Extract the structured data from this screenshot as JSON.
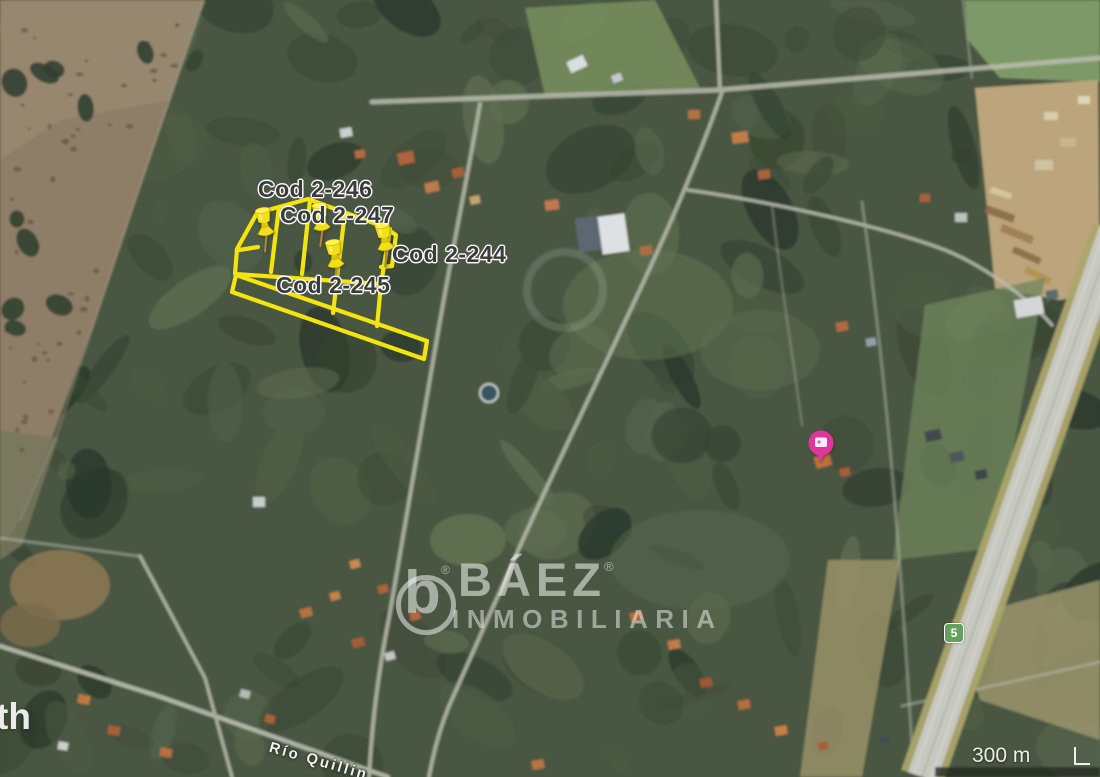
{
  "map": {
    "scale_label": "300 m",
    "route_shield": "5",
    "street_label": "Río Quillin",
    "corner_text": "th"
  },
  "parcels": {
    "items": [
      {
        "label": "Cod 2-246"
      },
      {
        "label": "Cod 2-247"
      },
      {
        "label": "Cod 2-244"
      },
      {
        "label": "Cod 2-245"
      }
    ]
  },
  "watermark": {
    "logo_letter": "b",
    "brand": "BÁEZ",
    "registered": "®",
    "subtitle": "INMOBILIARIA"
  },
  "colors": {
    "parcel_yellow": "#f4e40e",
    "pushpin_yellow": "#f2df15",
    "poi_pink": "#e0359c",
    "shield_green": "#64a15e",
    "label_text": "#3b3b3b"
  }
}
